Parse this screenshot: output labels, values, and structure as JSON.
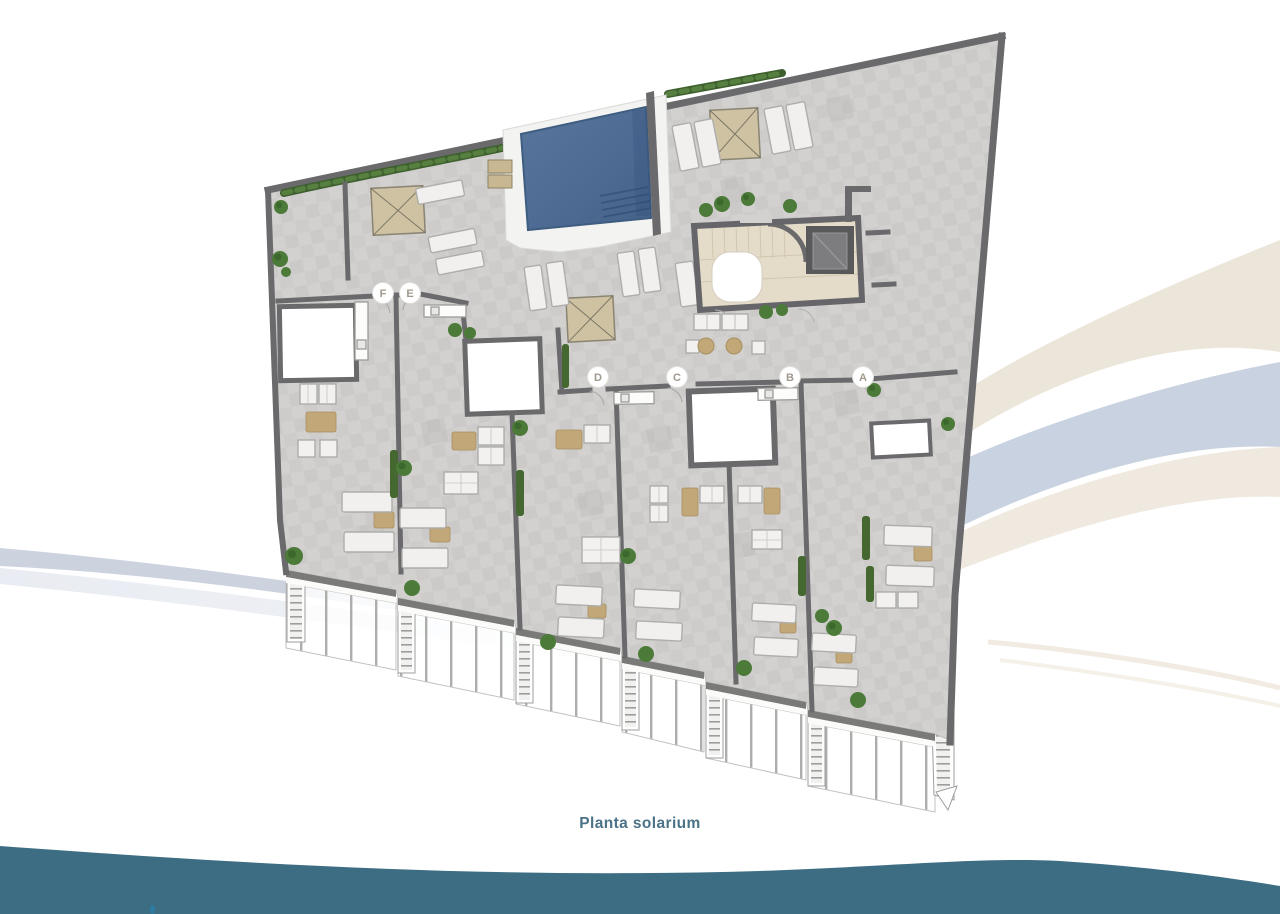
{
  "page": {
    "background_color": "#ffffff",
    "caption": "Planta solarium",
    "caption_color": "#4b7287"
  },
  "plan": {
    "title": "Planta solarium",
    "type": "roof-terrace floor plan",
    "units": [
      {
        "label": "F",
        "x": 383,
        "y": 293
      },
      {
        "label": "E",
        "x": 410,
        "y": 293
      },
      {
        "label": "D",
        "x": 598,
        "y": 377
      },
      {
        "label": "C",
        "x": 677,
        "y": 377
      },
      {
        "label": "B",
        "x": 790,
        "y": 377
      },
      {
        "label": "A",
        "x": 863,
        "y": 377
      }
    ],
    "bubble": {
      "radius": 10.5,
      "fill": "#ffffff",
      "stroke": "#e0dedb",
      "text_color": "#a1998d"
    },
    "features": [
      "communal swimming pool",
      "pergolas",
      "sun loungers",
      "stair and lift core",
      "private solarium terraces",
      "glass balustrades",
      "planters and hedges",
      "terrace staircases"
    ],
    "colors": {
      "floor_tile": "#d2d1cf",
      "floor_tile_dark": "#c6c5c3",
      "wall": "#6a6a6c",
      "pool_water": "#4f6d93",
      "pool_deck": "#f3f3f1",
      "pergola": "#cec2a2",
      "stair_core_floor": "#e4dbc8",
      "elevator": "#59595b",
      "greenery": "#4b7a39",
      "hedge": "#3e5f2e",
      "railing": "#fbfbfa",
      "furniture_table": "#c2a878"
    }
  },
  "decor": {
    "bottom_wave_color": "#3d6d83",
    "swoosh_blue": "#c9d2e1",
    "swoosh_cream": "#ece5d9",
    "left_swoosh_blue": "#ccd3df",
    "logo_dot_color": "#2e7aa0"
  }
}
